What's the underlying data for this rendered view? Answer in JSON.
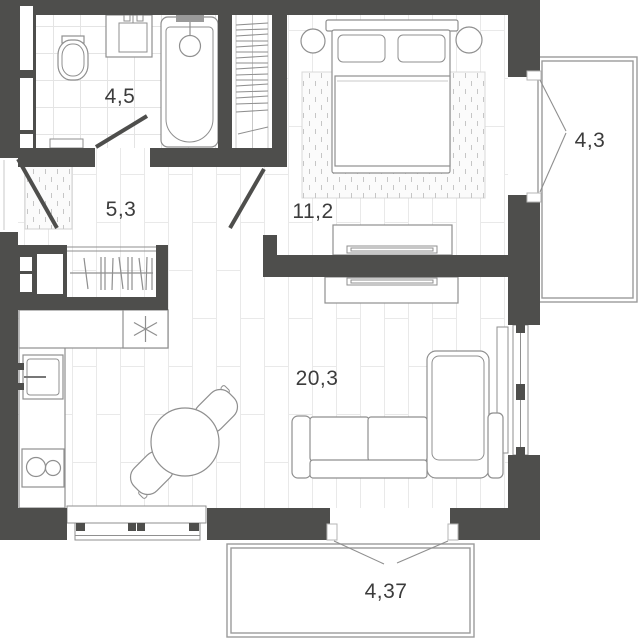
{
  "floor_plan": {
    "rooms": [
      {
        "name": "bathroom",
        "area": "4,5"
      },
      {
        "name": "hallway",
        "area": "5,3"
      },
      {
        "name": "bedroom",
        "area": "11,2"
      },
      {
        "name": "balcony-right",
        "area": "4,3"
      },
      {
        "name": "living-kitchen",
        "area": "20,3"
      },
      {
        "name": "balcony-bottom",
        "area": "4,37"
      }
    ],
    "fixtures": [
      "toilet",
      "sink-vanity",
      "bathtub",
      "shower-head",
      "wardrobe",
      "entrance-doormat",
      "hallway-closet",
      "radiator",
      "kitchen-counter",
      "fridge",
      "kitchen-sink",
      "hob",
      "dining-table",
      "chair",
      "sofa",
      "tv-stand",
      "tv",
      "bed",
      "pillows",
      "blanket",
      "nightstand",
      "rug",
      "dresser",
      "window",
      "balcony",
      "door"
    ],
    "colors": {
      "wall": "#4e4e4c",
      "outline": "#8f8f8f",
      "balcony_line": "#9b9b9b",
      "floor_line": "#e9e9e9",
      "tile_line": "#e4e4e4",
      "hatch": "#c6c6c6",
      "text": "#3c3c3c",
      "background": "#ffffff"
    }
  }
}
